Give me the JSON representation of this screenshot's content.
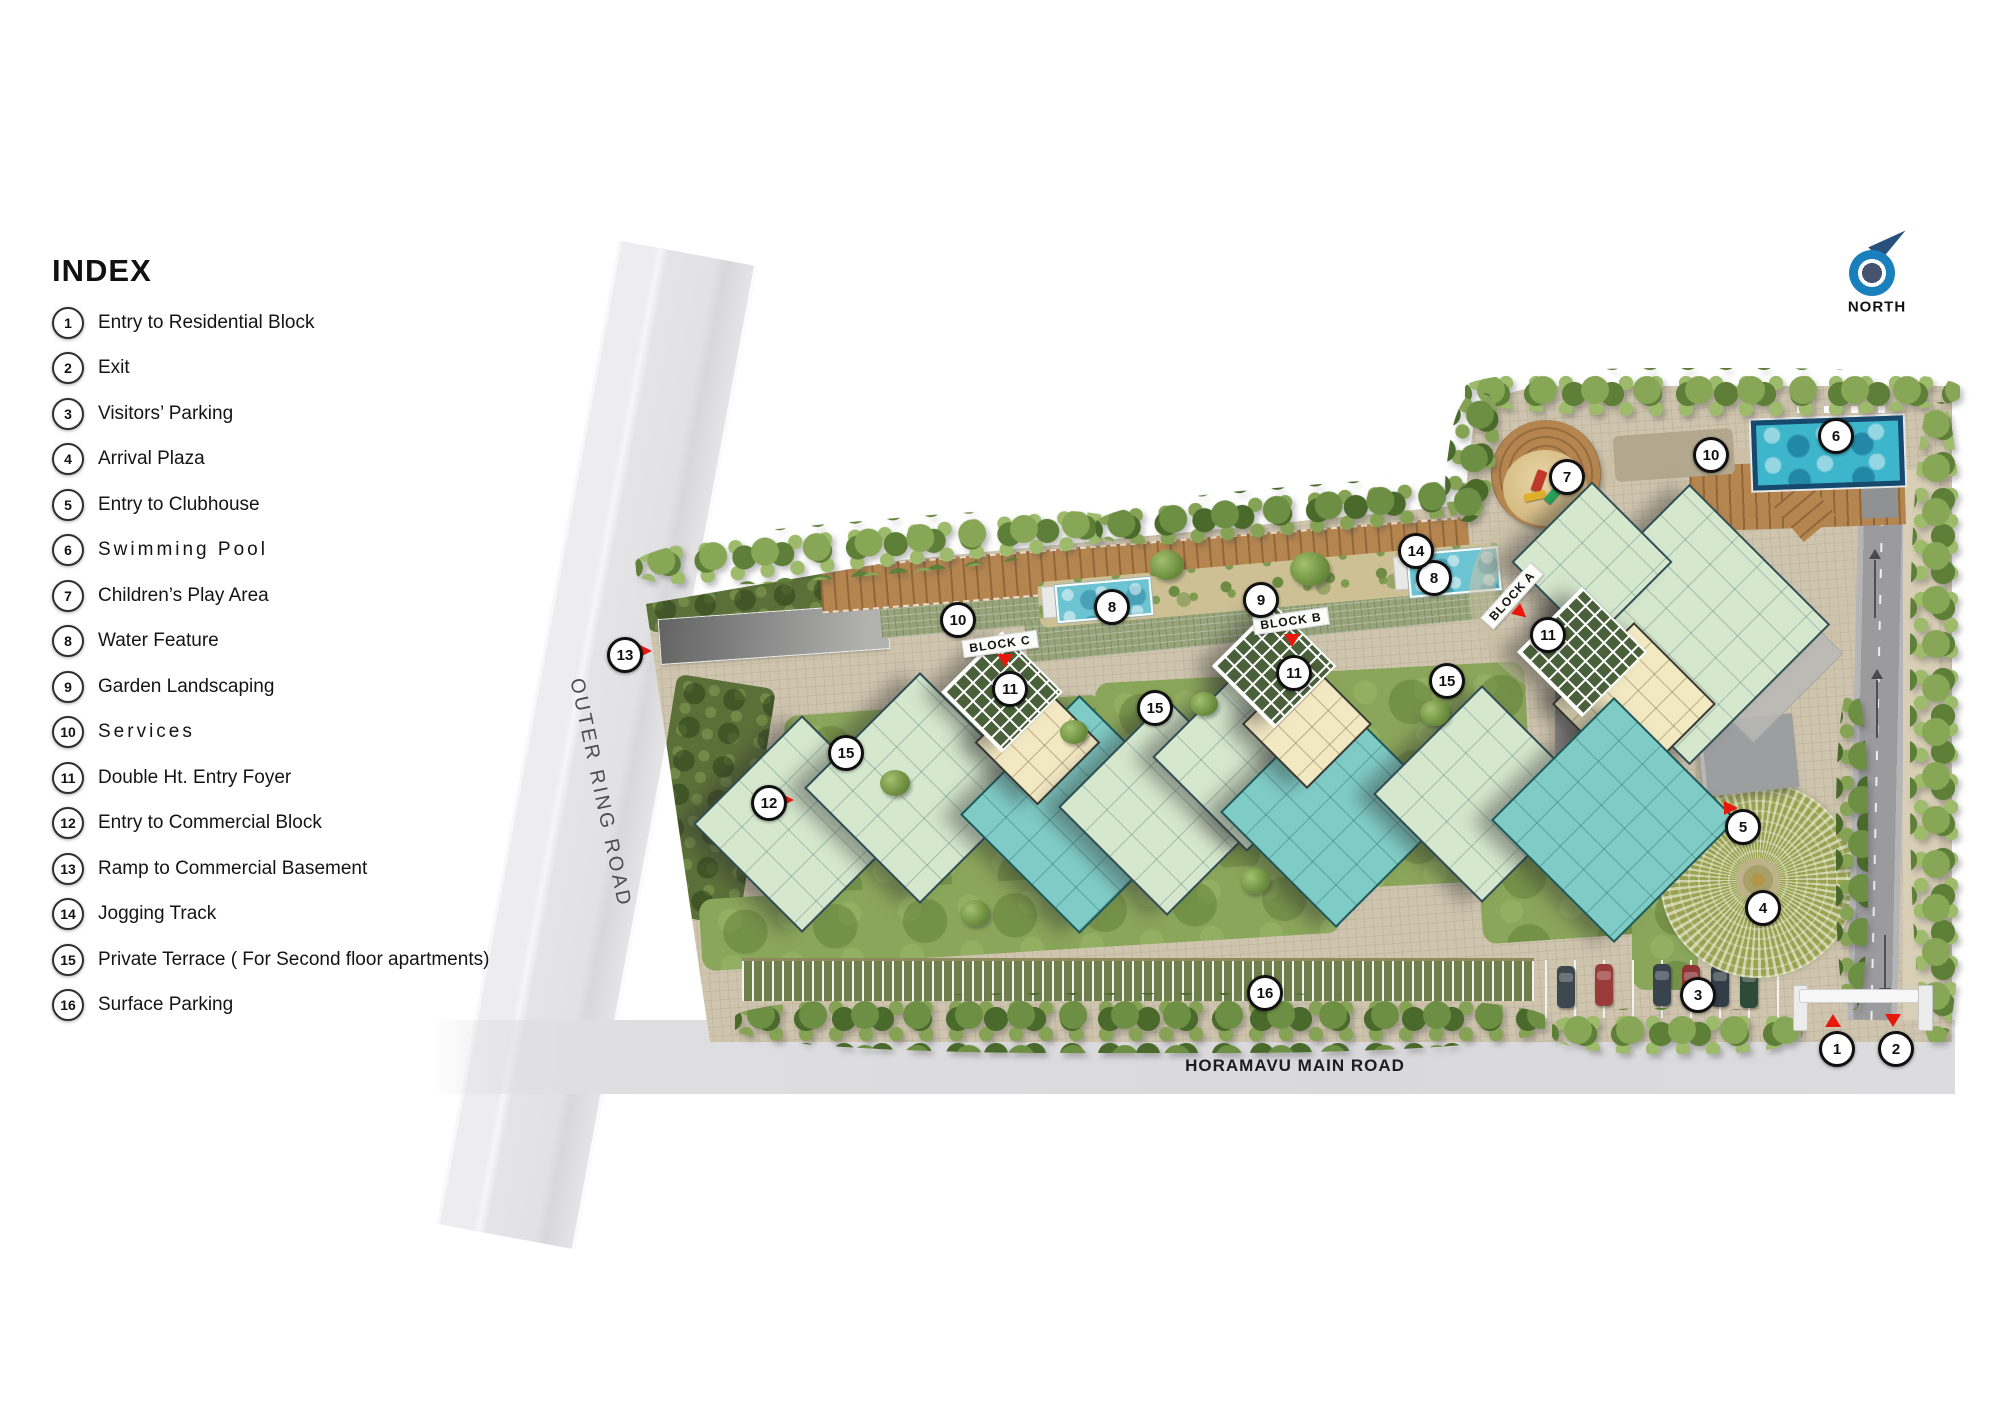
{
  "legend": {
    "title": "INDEX",
    "items": [
      {
        "num": "1",
        "label": "Entry to Residential Block"
      },
      {
        "num": "2",
        "label": "Exit"
      },
      {
        "num": "3",
        "label": "Visitors’ Parking"
      },
      {
        "num": "4",
        "label": "Arrival Plaza"
      },
      {
        "num": "5",
        "label": "Entry to Clubhouse"
      },
      {
        "num": "6",
        "label": "Swimming Pool"
      },
      {
        "num": "7",
        "label": "Children’s Play Area"
      },
      {
        "num": "8",
        "label": "Water Feature"
      },
      {
        "num": "9",
        "label": "Garden Landscaping"
      },
      {
        "num": "10",
        "label": "Services"
      },
      {
        "num": "11",
        "label": "Double Ht. Entry Foyer"
      },
      {
        "num": "12",
        "label": "Entry to Commercial Block"
      },
      {
        "num": "13",
        "label": "Ramp to Commercial Basement"
      },
      {
        "num": "14",
        "label": "Jogging Track"
      },
      {
        "num": "15",
        "label": "Private Terrace ( For Second floor apartments)"
      },
      {
        "num": "16",
        "label": "Surface Parking"
      }
    ]
  },
  "compass": {
    "label": "NORTH"
  },
  "roads": {
    "vertical": "OUTER RING ROAD",
    "horizontal": "HORAMAVU MAIN ROAD"
  },
  "blocks": [
    {
      "label": "BLOCK A"
    },
    {
      "label": "BLOCK B"
    },
    {
      "label": "BLOCK C"
    }
  ],
  "marker_instances": [
    "1",
    "2",
    "3",
    "4",
    "5",
    "6",
    "7",
    "8",
    "8",
    "9",
    "10",
    "10",
    "11",
    "11",
    "11",
    "12",
    "13",
    "14",
    "15",
    "15",
    "15",
    "16"
  ],
  "colors": {
    "accent_red": "#e8190c",
    "compass_blue": "#1a80bd",
    "pool_blue": "#3db5cb",
    "water_feature_blue": "#6cc3d2",
    "building_light_green": "#d5e7cd",
    "building_teal": "#7fccc6",
    "building_cream": "#f2e8c2",
    "paving_tan": "#cfc5af",
    "grass_green": "#8aa65a",
    "road_grey": "#dcdcde",
    "wood_deck": "#b5854f"
  }
}
